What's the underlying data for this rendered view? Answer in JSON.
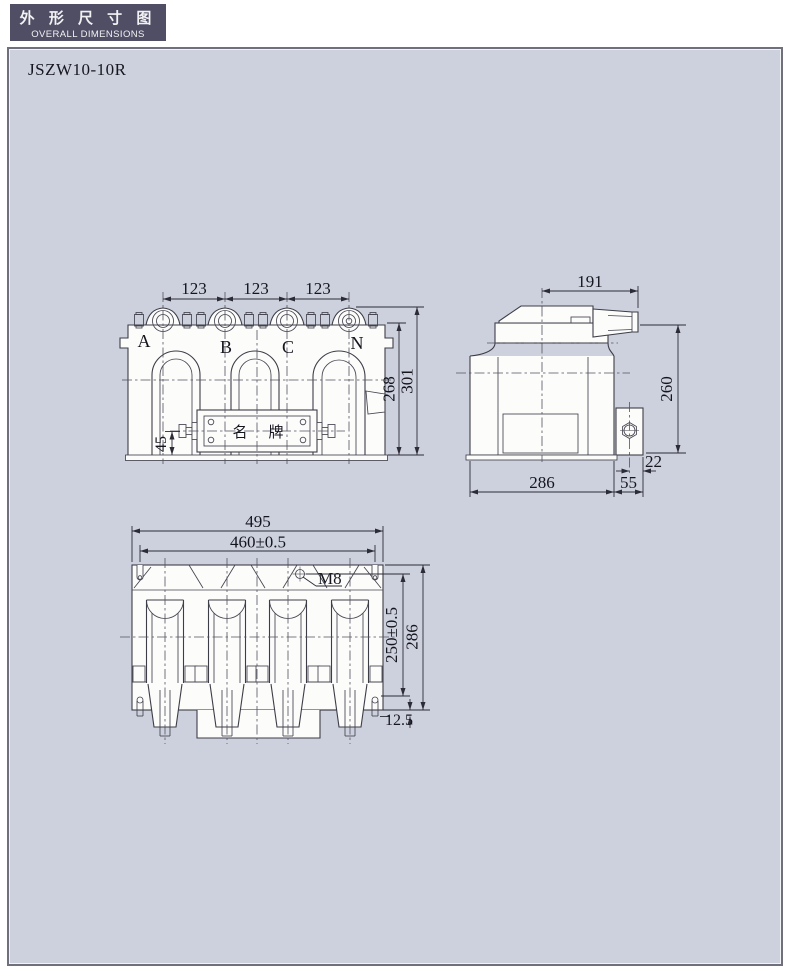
{
  "badge": {
    "title_cn": "外 形 尺 寸 图",
    "title_en": "OVERALL DIMENSIONS"
  },
  "model": "JSZW10-10R",
  "colors": {
    "badge_bg": "#4f4e64",
    "panel_bg": "#cdd1dd",
    "line": "#3d3d47",
    "shape_fill": "#fcfcfb"
  },
  "front_view": {
    "terminals": [
      "A",
      "B",
      "C",
      "N"
    ],
    "nameplate_cn_left": "名",
    "nameplate_cn_right": "牌",
    "dim_pitch_1": "123",
    "dim_pitch_2": "123",
    "dim_pitch_3": "123",
    "dim_height_body": "268",
    "dim_height_total": "301",
    "dim_base_to_bolt": "45"
  },
  "side_view": {
    "dim_head_width": "191",
    "dim_height": "260",
    "dim_depth": "286",
    "dim_bracket": "55",
    "dim_hole": "22"
  },
  "bottom_view": {
    "dim_width_overall": "495",
    "dim_slot_pitch": "460±0.5",
    "thread": "M8",
    "dim_depth_pitch": "250±0.5",
    "dim_depth_overall": "286",
    "dim_offset": "12.5"
  }
}
